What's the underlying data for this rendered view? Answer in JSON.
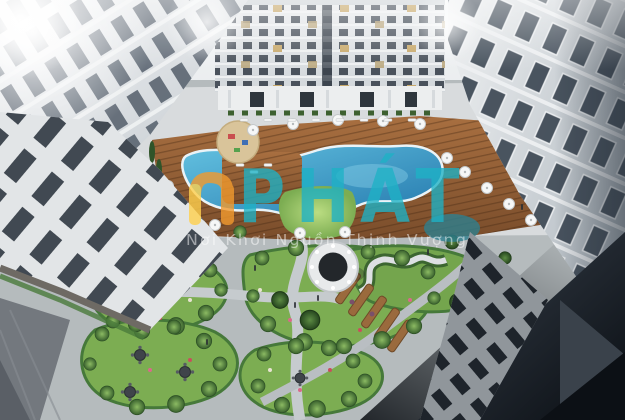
{
  "scene": {
    "description": "Aerial 3D render of an apartment complex inner courtyard with swimming pool, wooden deck, landscaped garden islands, round pavilion and winding paths, enclosed by white high-rise towers; bright flare top-left, dark shaded building corner bottom-right",
    "palette": {
      "facade": "#dde1e5",
      "window_dark": "#4d565f",
      "pool_blue": "#2e8fc4",
      "deck_wood": "#91613a",
      "lawn_green": "#85b95b",
      "hedge_green": "#3d6630",
      "path_grey": "#c7cccf",
      "shadow_corner": "#0d1117"
    }
  },
  "watermark": {
    "brand_text": "PHÁT",
    "tagline": "Nơi Khơi Nguồn Thịnh Vượng",
    "brand_color": "#1eb2c6",
    "icon_orange": "#f29a2e",
    "icon_yellow": "#ffd04d",
    "tagline_color": "#ffffff"
  }
}
